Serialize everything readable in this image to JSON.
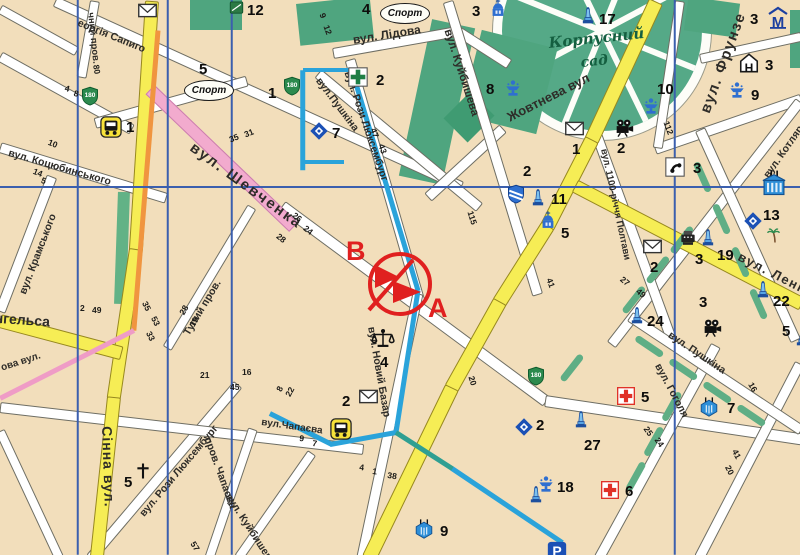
{
  "map": {
    "park": {
      "line1": "Корпусний",
      "line2": "сад"
    },
    "annotation": {
      "letter_b": "В",
      "letter_a": "А"
    },
    "glyphs": {
      "hotel": "Н",
      "metro": "М",
      "parking": "Р",
      "badge": "180",
      "church_cross": "†",
      "sport": "Спорт"
    },
    "street_labels": [
      {
        "text": "вул. Шевченка",
        "x": 196,
        "y": 140,
        "rot": 36,
        "size": 15,
        "bold": true,
        "ls": 2
      },
      {
        "text": "вул. Лідова",
        "x": 352,
        "y": 34,
        "rot": -9,
        "size": 12,
        "bold": true
      },
      {
        "text": "вул.Пушкіна",
        "x": 322,
        "y": 76,
        "rot": 53,
        "size": 10.5
      },
      {
        "text": "вул. Рози Люксембург",
        "x": 352,
        "y": 70,
        "rot": 71,
        "size": 10.5
      },
      {
        "text": "вул. Куйбишева",
        "x": 452,
        "y": 28,
        "rot": 72,
        "size": 11.5
      },
      {
        "text": "Жовтнева вул",
        "x": 505,
        "y": 112,
        "rot": -27,
        "size": 13,
        "bold": true
      },
      {
        "text": "вул. Фрунзе",
        "x": 698,
        "y": 110,
        "rot": -70,
        "size": 15,
        "bold": true,
        "ls": 1.5
      },
      {
        "text": "вул. Котляревського",
        "x": 762,
        "y": 174,
        "rot": -55,
        "size": 10.5
      },
      {
        "text": "вул. 1100-річчя Полтави",
        "x": 608,
        "y": 148,
        "rot": 78,
        "size": 9.5
      },
      {
        "text": "вул. Леніна",
        "x": 742,
        "y": 250,
        "rot": 27,
        "size": 13,
        "bold": true,
        "ls": 1.5
      },
      {
        "text": "вул. Гоголя",
        "x": 662,
        "y": 362,
        "rot": 62,
        "size": 10.5
      },
      {
        "text": "вул. Пушкіна",
        "x": 672,
        "y": 330,
        "rot": 34,
        "size": 10.5
      },
      {
        "text": "вул. Коцюбинського",
        "x": 10,
        "y": 148,
        "rot": 16,
        "size": 10.5
      },
      {
        "text": "вул. Крамського",
        "x": 18,
        "y": 292,
        "rot": -69,
        "size": 10.5
      },
      {
        "text": "еоргія Сапиго",
        "x": 80,
        "y": 18,
        "rot": 22,
        "size": 10.5
      },
      {
        "text": "чний пров.",
        "x": 95,
        "y": 12,
        "rot": 84,
        "size": 9.5
      },
      {
        "text": "Енгельса",
        "x": -14,
        "y": 310,
        "rot": 4,
        "size": 14,
        "bold": true
      },
      {
        "text": "Тупий пров.",
        "x": 182,
        "y": 332,
        "rot": -59,
        "size": 10.5
      },
      {
        "text": "Сінна вул.",
        "x": 114,
        "y": 426,
        "rot": 88,
        "size": 14,
        "bold": true,
        "ls": 1
      },
      {
        "text": "вул. Рози Люксембург",
        "x": 138,
        "y": 512,
        "rot": -50,
        "size": 10.5
      },
      {
        "text": "пров. Чапаєва",
        "x": 212,
        "y": 436,
        "rot": 70,
        "size": 10.5
      },
      {
        "text": "вул. Куйбишева",
        "x": 232,
        "y": 492,
        "rot": 57,
        "size": 10.5
      },
      {
        "text": "вул.Чапаєва",
        "x": 262,
        "y": 418,
        "rot": 8,
        "size": 10
      },
      {
        "text": "вул. Новий Базар",
        "x": 376,
        "y": 326,
        "rot": 80,
        "size": 10.5
      },
      {
        "text": "ова вул.",
        "x": 0,
        "y": 364,
        "rot": -18,
        "size": 10
      }
    ],
    "house_numbers": [
      [
        228,
        136,
        -22,
        "35"
      ],
      [
        243,
        131,
        -22,
        "31"
      ],
      [
        100,
        64,
        80,
        "80"
      ],
      [
        66,
        84,
        14,
        "4"
      ],
      [
        75,
        89,
        14,
        "8"
      ],
      [
        50,
        138,
        22,
        "10"
      ],
      [
        35,
        167,
        22,
        "14"
      ],
      [
        43,
        176,
        22,
        "5"
      ],
      [
        80,
        304,
        0,
        "2"
      ],
      [
        92,
        306,
        0,
        "49"
      ],
      [
        148,
        300,
        62,
        "35"
      ],
      [
        157,
        315,
        62,
        "53"
      ],
      [
        152,
        330,
        62,
        "33"
      ],
      [
        178,
        312,
        -60,
        "28"
      ],
      [
        188,
        324,
        -60,
        "19"
      ],
      [
        200,
        371,
        0,
        "21"
      ],
      [
        242,
        368,
        0,
        "16"
      ],
      [
        230,
        383,
        0,
        "45"
      ],
      [
        196,
        540,
        58,
        "57"
      ],
      [
        275,
        389,
        -62,
        "8"
      ],
      [
        284,
        394,
        -62,
        "22"
      ],
      [
        300,
        434,
        8,
        "9"
      ],
      [
        313,
        439,
        8,
        "7"
      ],
      [
        360,
        463,
        8,
        "4"
      ],
      [
        373,
        467,
        8,
        "1"
      ],
      [
        388,
        471,
        8,
        "38"
      ],
      [
        475,
        375,
        72,
        "20"
      ],
      [
        553,
        277,
        70,
        "41"
      ],
      [
        624,
        275,
        40,
        "27"
      ],
      [
        640,
        287,
        40,
        "49"
      ],
      [
        649,
        425,
        55,
        "25"
      ],
      [
        660,
        436,
        55,
        "24"
      ],
      [
        738,
        448,
        62,
        "41"
      ],
      [
        731,
        464,
        62,
        "20"
      ],
      [
        754,
        381,
        60,
        "16"
      ],
      [
        474,
        210,
        72,
        "115"
      ],
      [
        670,
        120,
        70,
        "112"
      ],
      [
        385,
        143,
        70,
        "43"
      ],
      [
        377,
        127,
        70,
        "47"
      ],
      [
        296,
        211,
        38,
        "26"
      ],
      [
        307,
        224,
        38,
        "24"
      ],
      [
        280,
        232,
        38,
        "28"
      ],
      [
        326,
        12,
        70,
        "9"
      ],
      [
        330,
        24,
        70,
        "12"
      ]
    ],
    "pois": [
      {
        "type": "bus",
        "x": 100,
        "y": 116,
        "label": "1",
        "lx": 126,
        "ly": 120
      },
      {
        "type": "bus",
        "x": 330,
        "y": 418
      },
      {
        "type": "envelope",
        "x": 358,
        "y": 386,
        "label": "2",
        "lx": 342,
        "ly": 394
      },
      {
        "type": "envelope",
        "x": 137,
        "y": 0
      },
      {
        "type": "envelope",
        "x": 564,
        "y": 118,
        "label": "1",
        "lx": 572,
        "ly": 142
      },
      {
        "type": "envelope",
        "x": 642,
        "y": 236,
        "label": "2",
        "lx": 650,
        "ly": 260
      },
      {
        "type": "printer",
        "x": 678,
        "y": 228,
        "label": "3",
        "lx": 695,
        "ly": 252
      },
      {
        "type": "pharmacy",
        "x": 347,
        "y": 66,
        "label": "2",
        "lx": 376,
        "ly": 73
      },
      {
        "type": "redcross",
        "x": 616,
        "y": 386,
        "label": "5",
        "lx": 641,
        "ly": 390
      },
      {
        "type": "redcross",
        "x": 600,
        "y": 480,
        "label": "6",
        "lx": 625,
        "ly": 484
      },
      {
        "type": "shield",
        "x": 506,
        "y": 184,
        "label": "2",
        "lx": 523,
        "ly": 164
      },
      {
        "type": "badge",
        "x": 80,
        "y": 86
      },
      {
        "type": "badge",
        "x": 282,
        "y": 76,
        "label": "1",
        "lx": 268,
        "ly": 86
      },
      {
        "type": "badge",
        "x": 526,
        "y": 366
      },
      {
        "type": "diamond",
        "x": 308,
        "y": 120,
        "label": "7",
        "lx": 332,
        "ly": 126
      },
      {
        "type": "diamond",
        "x": 742,
        "y": 210,
        "label": "13",
        "lx": 763,
        "ly": 208
      },
      {
        "type": "diamond",
        "x": 513,
        "y": 416,
        "label": "2",
        "lx": 536,
        "ly": 418
      },
      {
        "type": "monument",
        "x": 578,
        "y": 6,
        "label": "17",
        "lx": 599,
        "ly": 12
      },
      {
        "type": "monument",
        "x": 528,
        "y": 188,
        "label": "11",
        "lx": 551,
        "ly": 192
      },
      {
        "type": "monument",
        "x": 627,
        "y": 306,
        "label": "24",
        "lx": 647,
        "ly": 314
      },
      {
        "type": "monument",
        "x": 571,
        "y": 410,
        "label": "27",
        "lx": 584,
        "ly": 438
      },
      {
        "type": "monument",
        "x": 698,
        "y": 228,
        "label": "19",
        "lx": 717,
        "ly": 248
      },
      {
        "type": "monument",
        "x": 753,
        "y": 280,
        "label": "22",
        "lx": 773,
        "ly": 294
      },
      {
        "type": "monument",
        "x": 792,
        "y": 328,
        "label": "5",
        "lx": 782,
        "ly": 324
      },
      {
        "type": "monument",
        "x": 526,
        "y": 485
      },
      {
        "type": "fountain",
        "x": 503,
        "y": 78,
        "label": "8",
        "lx": 486,
        "ly": 82
      },
      {
        "type": "fountain",
        "x": 641,
        "y": 96,
        "label": "10",
        "lx": 657,
        "ly": 82
      },
      {
        "type": "fountain",
        "x": 727,
        "y": 80,
        "label": "9",
        "lx": 751,
        "ly": 88
      },
      {
        "type": "fountain",
        "x": 536,
        "y": 474,
        "label": "18",
        "lx": 557,
        "ly": 480
      },
      {
        "type": "church",
        "x": 538,
        "y": 210,
        "label": "5",
        "lx": 561,
        "ly": 226
      },
      {
        "type": "church",
        "x": 488,
        "y": -2,
        "label": "3",
        "lx": 472,
        "ly": 4
      },
      {
        "type": "greensq",
        "x": 229,
        "y": 0,
        "label": "12",
        "lx": 247,
        "ly": 3
      },
      {
        "type": "camera",
        "x": 613,
        "y": 116,
        "label": "2",
        "lx": 617,
        "ly": 141
      },
      {
        "type": "camera",
        "x": 701,
        "y": 316,
        "label": "3",
        "lx": 699,
        "ly": 295
      },
      {
        "type": "phone",
        "x": 664,
        "y": 156,
        "label": "3",
        "lx": 693,
        "ly": 161
      },
      {
        "type": "scales",
        "x": 370,
        "y": 328,
        "label": "4",
        "lx": 380,
        "ly": 355
      },
      {
        "type": "crossT",
        "x": 134,
        "y": 462,
        "label": "5",
        "lx": 124,
        "ly": 475
      },
      {
        "type": "hotel",
        "x": 738,
        "y": 52,
        "label": "3",
        "lx": 765,
        "ly": 58
      },
      {
        "type": "mbuilding",
        "x": 766,
        "y": 6,
        "label": "3",
        "lx": 750,
        "ly": 12
      },
      {
        "type": "theaterBig",
        "x": 760,
        "y": 170
      },
      {
        "type": "theater",
        "x": 698,
        "y": 396,
        "label": "7",
        "lx": 727,
        "ly": 401
      },
      {
        "type": "theater",
        "x": 413,
        "y": 518,
        "label": "9",
        "lx": 440,
        "ly": 524
      },
      {
        "type": "palm",
        "x": 766,
        "y": 226
      },
      {
        "type": "parking",
        "x": 546,
        "y": 540
      },
      {
        "type": "sport",
        "x": 184,
        "y": 80,
        "label": "5",
        "lx": 199,
        "ly": 62
      },
      {
        "type": "sport",
        "x": 380,
        "y": 3,
        "label": "4",
        "lx": 362,
        "ly": 2
      }
    ]
  }
}
